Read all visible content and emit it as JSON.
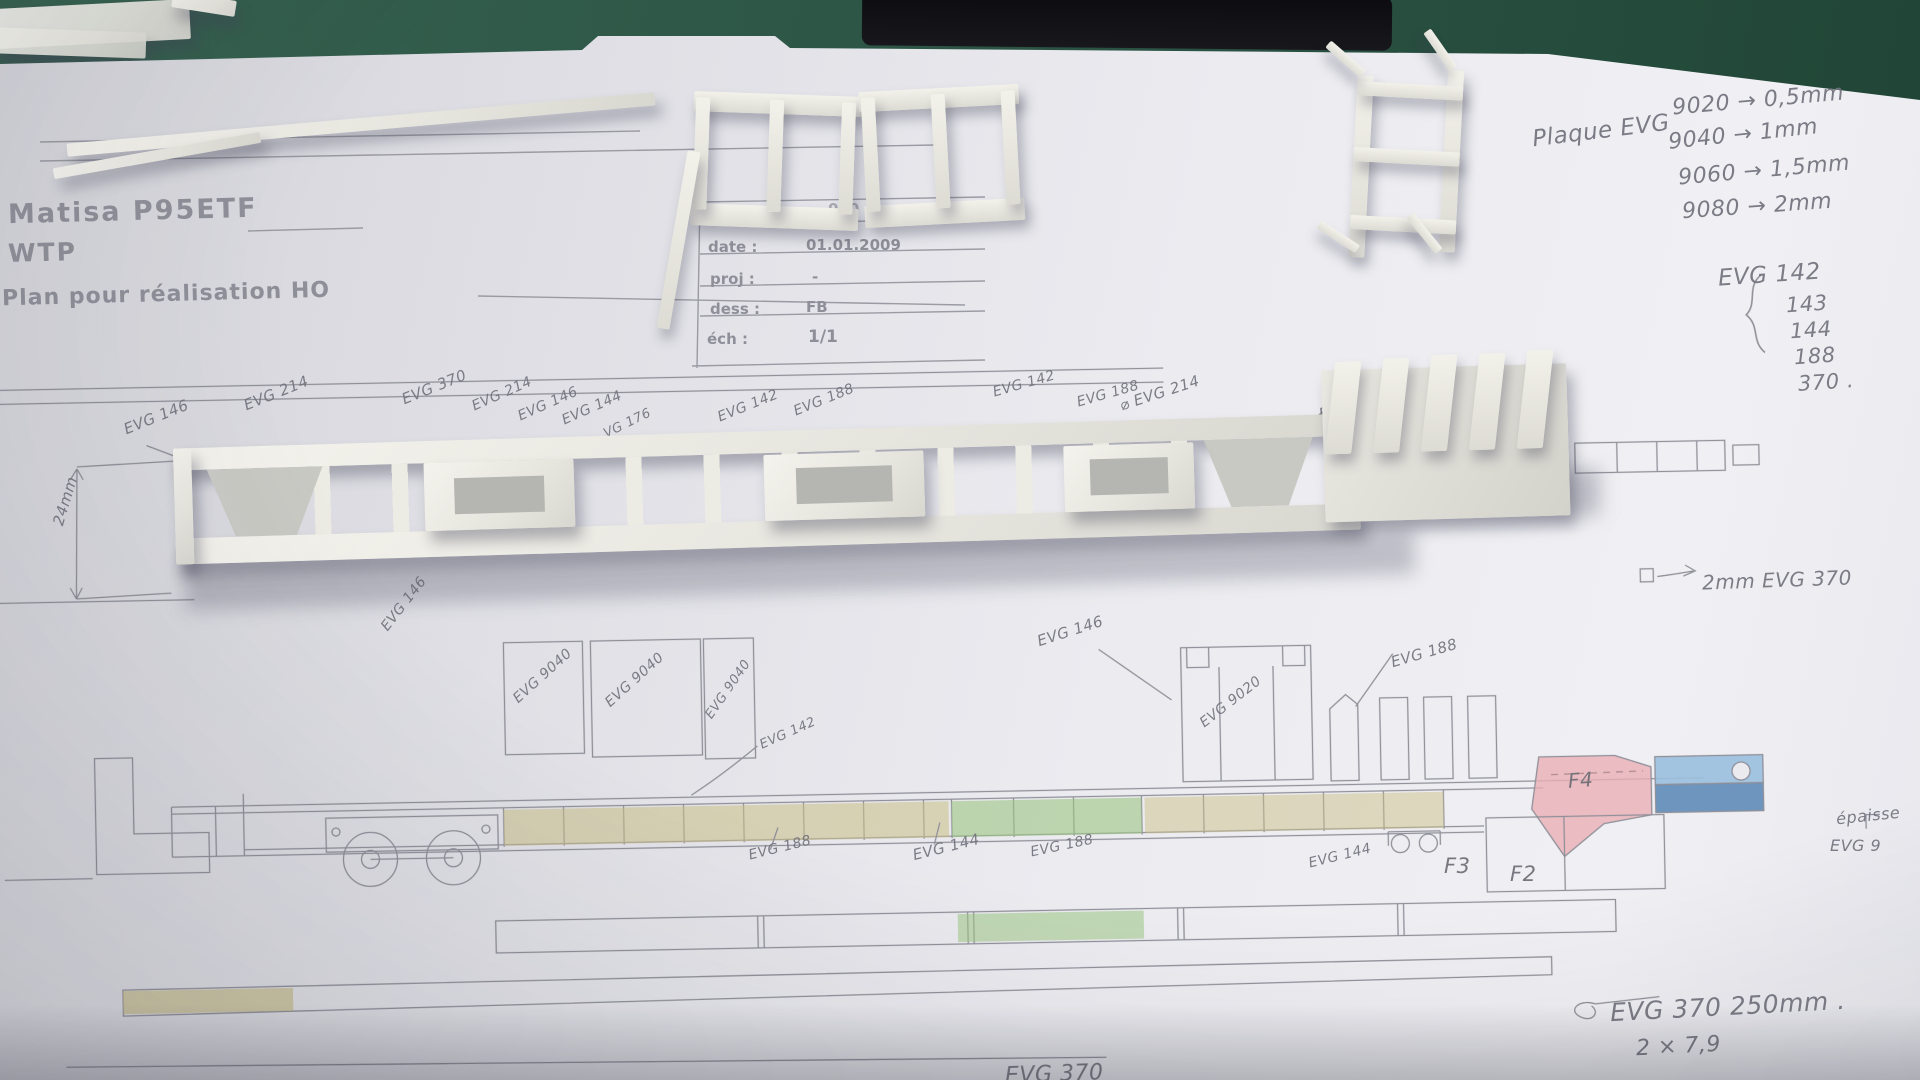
{
  "brand": {
    "line1": "Matisa P95ETF",
    "line2": "WTP",
    "line3": "Plan pour réalisation HO"
  },
  "title_block": {
    "plan_label": "plan n°:",
    "plan_value": "000",
    "date_label": "date :",
    "date_value": "01.01.2009",
    "proj_label": "proj :",
    "proj_value": "-",
    "dess_label": "dess :",
    "dess_value": "FB",
    "ech_label": "éch :",
    "ech_value": "1/1"
  },
  "plaque_note": {
    "prefix": "Plaque EVG",
    "rows": [
      "9020 → 0,5mm",
      "9040 → 1mm",
      "9060 → 1,5mm",
      "9080 → 2mm"
    ]
  },
  "evg_list": {
    "head": "EVG 142",
    "items": [
      "143",
      "144",
      "188",
      "370 ."
    ]
  },
  "notes": {
    "thickness": "2mm EVG 370",
    "length": "EVG 370 250mm .",
    "length_detail": "2 × 7,9",
    "edge_line1": "épaisse",
    "edge_line2": "EVG 9",
    "dim_left": "24mm",
    "bottom_cut": "EVG 370"
  },
  "part_labels": {
    "t1": "EVG 146",
    "t2": "EVG 214",
    "t3": "EVG 370",
    "t4": "EVG 214",
    "t5": "EVG 146",
    "t6": "EVG 144",
    "t7": "VG 176",
    "t8": "EVG 142",
    "t9": "EVG 188",
    "t10": "EVG 142",
    "t11": "EVG 188",
    "t12": "⌀ EVG 214",
    "t13": "EVG 188",
    "m1": "EVG 146",
    "m2": "EVG 9040",
    "m3": "EVG 9040",
    "m4": "EVG 9040",
    "m5": "EVG 142",
    "m6": "EVG 146",
    "m7": "EVG 9020",
    "m8": "EVG 188",
    "b1": "EVG 188",
    "b2": "EVG 144",
    "b3": "EVG 188",
    "b4": "EVG 144",
    "f2": "F2",
    "f3": "F3",
    "f4": "F4"
  },
  "colors": {
    "mat_green": "#2a5243",
    "pencil": "#85858f",
    "olive": "#c6ba7c",
    "green": "#93c277",
    "pink": "#e8a8ac",
    "blue_light": "#8fb9da",
    "blue_dark": "#4f7fb0"
  }
}
